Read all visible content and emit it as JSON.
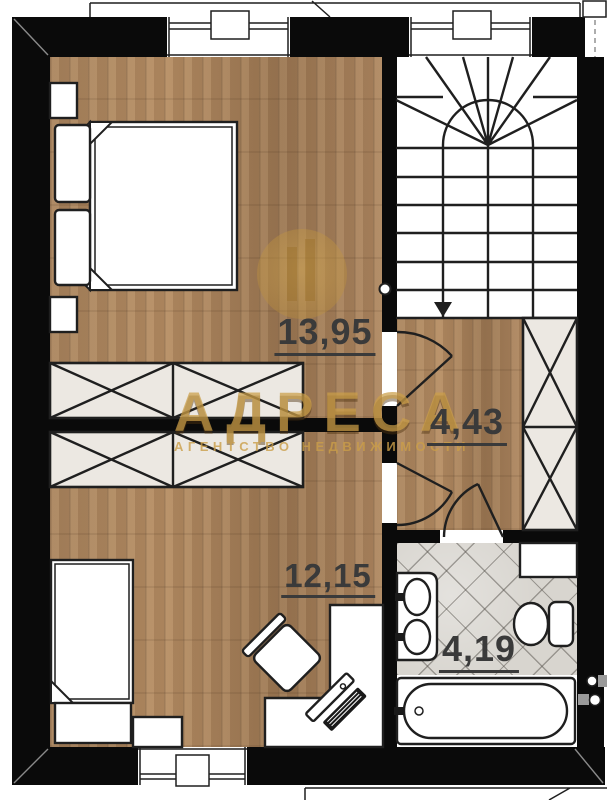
{
  "plan": {
    "watermark": {
      "brand": "АДРЕСА",
      "subtitle": "АГЕНТСТВО НЕДВИЖИМОСТИ"
    },
    "rooms": {
      "bedroom_top": {
        "area": "13,95"
      },
      "hallway": {
        "area": "4,43"
      },
      "bedroom_bottom": {
        "area": "12,15"
      },
      "bathroom": {
        "area": "4,19"
      }
    }
  },
  "colors": {
    "wall": "#0a0a0a",
    "line": "#1f1f1f",
    "wood": "#a8835d",
    "tile": "#d8d5cf",
    "cabinet": "#ece8e2",
    "gold": "#c99c4a",
    "label": "#3a3a3a",
    "white": "#ffffff"
  }
}
